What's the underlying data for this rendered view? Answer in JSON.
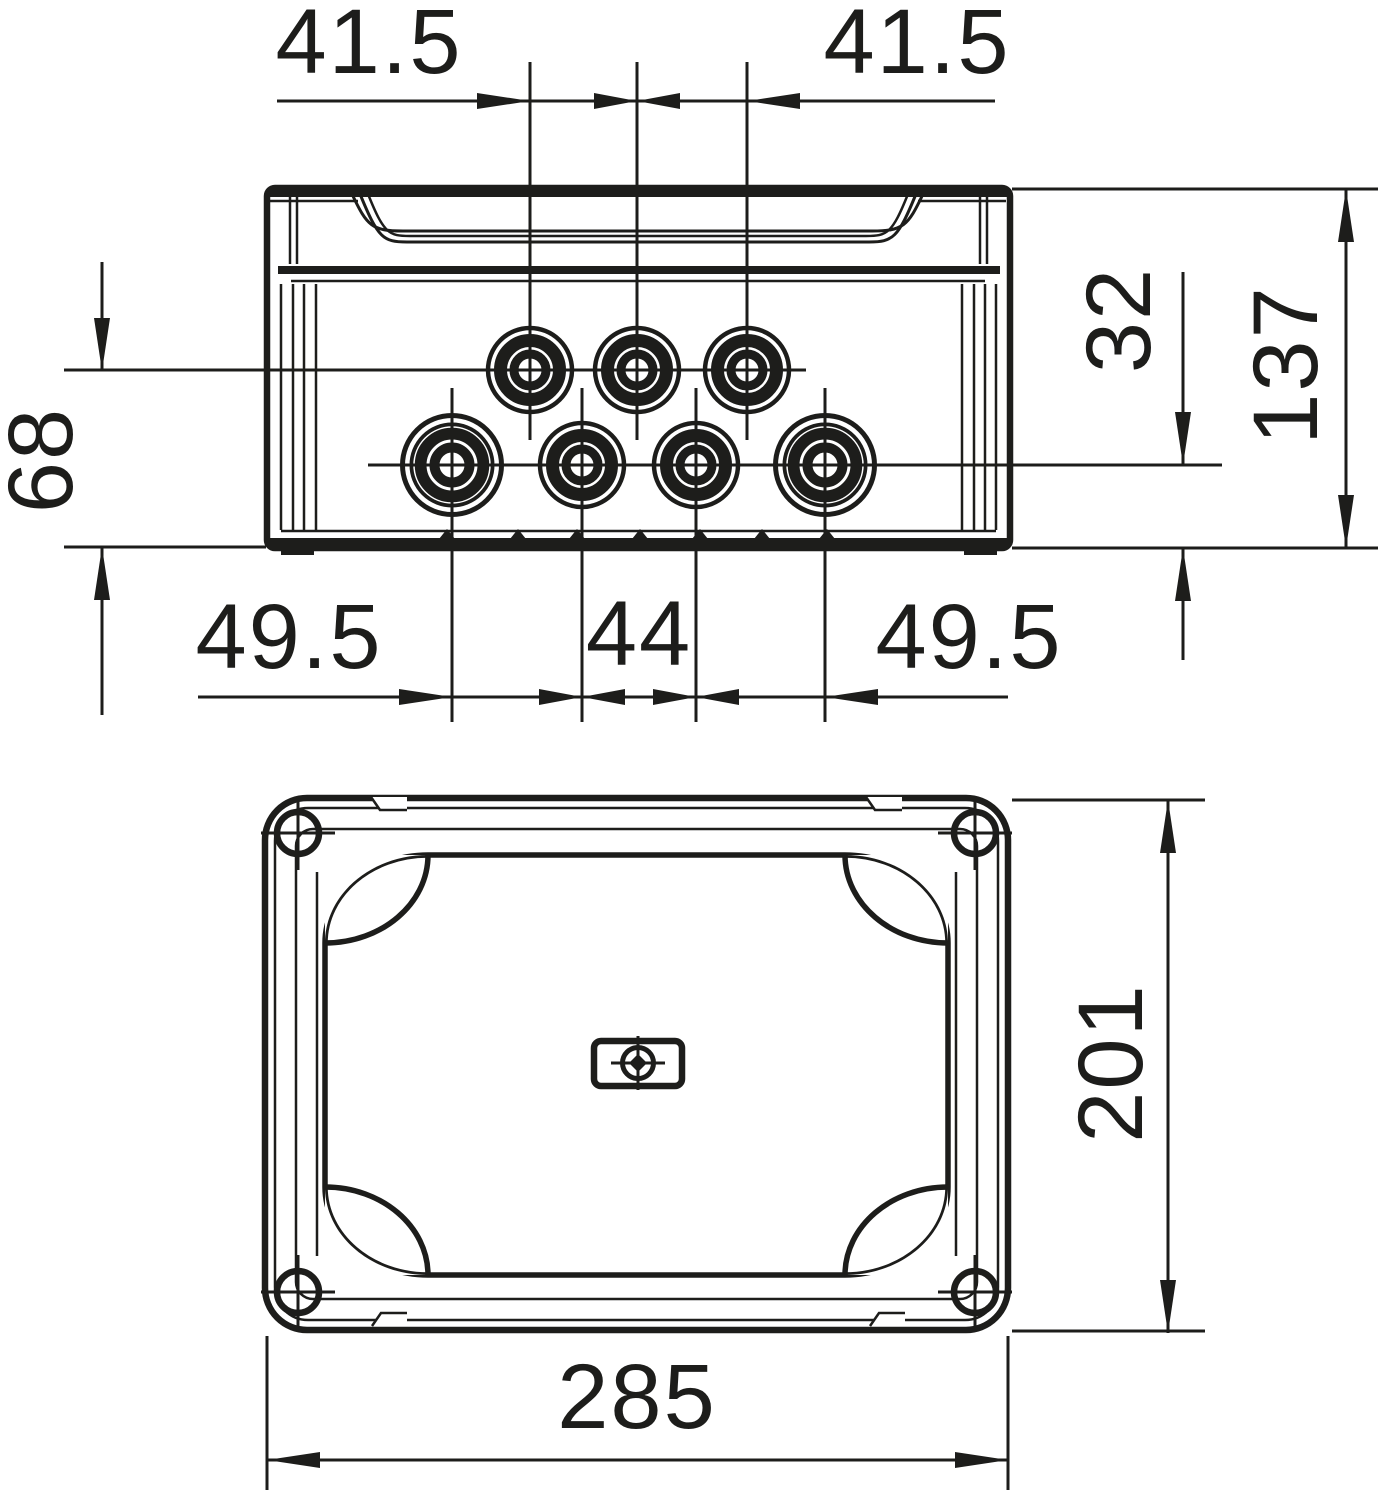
{
  "drawing": {
    "title": "junction-box dimensional drawing, two views",
    "colors": {
      "line": "#1d1d1b",
      "background": "#ffffff"
    },
    "dimensions": {
      "top_pitch_left": "41.5",
      "top_pitch_right": "41.5",
      "entry_row_offset_left": "68",
      "entry_row_gap_right": "32",
      "box_height": "137",
      "bottom_pitch_left": "49.5",
      "bottom_pitch_center": "44",
      "bottom_pitch_right": "49.5",
      "plan_width": "285",
      "plan_depth": "201"
    },
    "features": {
      "cable_entries_top_row": 3,
      "cable_entries_bottom_row": 4,
      "lid_screws": 4,
      "center_knockout_markings": 1
    }
  }
}
